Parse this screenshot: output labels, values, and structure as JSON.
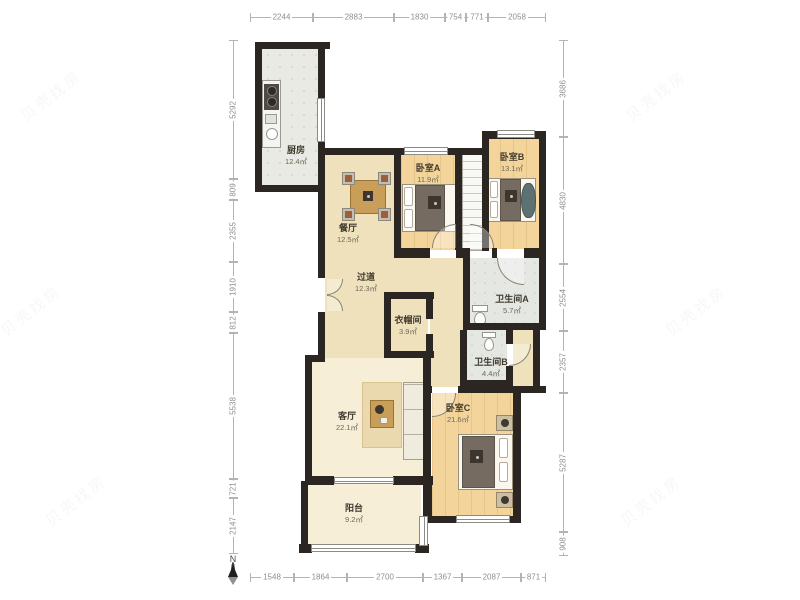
{
  "plan": {
    "rooms": {
      "kitchen": {
        "name": "厨房",
        "area": "12.4㎡"
      },
      "dining": {
        "name": "餐厅",
        "area": "12.5㎡"
      },
      "bedroom_a": {
        "name": "卧室A",
        "area": "11.9㎡"
      },
      "bedroom_b": {
        "name": "卧室B",
        "area": "13.1㎡"
      },
      "hallway": {
        "name": "过道",
        "area": "12.3㎡"
      },
      "closet": {
        "name": "衣帽间",
        "area": "3.9㎡"
      },
      "bathroom_a": {
        "name": "卫生间A",
        "area": "5.7㎡"
      },
      "bathroom_b": {
        "name": "卫生间B",
        "area": "4.4㎡"
      },
      "living": {
        "name": "客厅",
        "area": "22.1㎡"
      },
      "bedroom_c": {
        "name": "卧室C",
        "area": "21.6㎡"
      },
      "balcony": {
        "name": "阳台",
        "area": "9.2㎡"
      }
    },
    "compass": {
      "label": "N"
    },
    "watermark": {
      "text": "贝壳找房"
    },
    "dimensions": {
      "top": [
        "2244",
        "2883",
        "1830",
        "754",
        "771",
        "2058"
      ],
      "bottom": [
        "1548",
        "1864",
        "2700",
        "1367",
        "2087",
        "871"
      ],
      "left": [
        "5292",
        "809",
        "2355",
        "1910",
        "812",
        "5538",
        "721",
        "2147"
      ],
      "right": [
        "3686",
        "4830",
        "2554",
        "2357",
        "5287",
        "908"
      ]
    },
    "colors": {
      "wall": "#2b2622",
      "bedroom_floor": "#f3d49b",
      "hall_floor": "#efe1bc",
      "living_floor": "#f7eed8",
      "kitchen_floor": "#e9eae3",
      "dim_text": "#8f8f8f"
    }
  }
}
